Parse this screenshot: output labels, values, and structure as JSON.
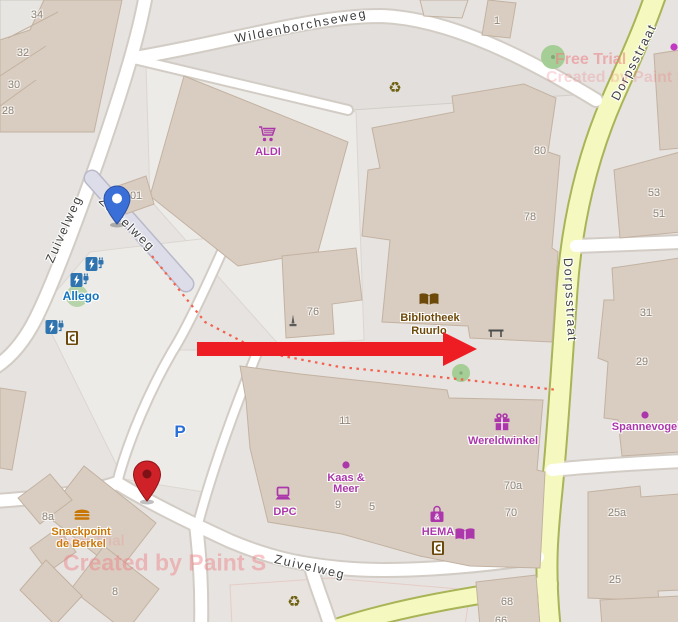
{
  "map": {
    "colors": {
      "background": "#e6e3e0",
      "building_fill": "#d9cdc1",
      "building_stroke": "#c3b2a1",
      "road_white": "#ffffff",
      "road_casing": "#d2ccc5",
      "secondary_road_fill": "#f5f9c0",
      "secondary_road_casing": "#a8b456",
      "pedestrian_road_fill": "#dcdde9",
      "path_dotted": "#f4604c",
      "shop_magenta": "#ab37ab",
      "amenity_brown": "#6e4a0a",
      "gastronomy_orange": "#c97704",
      "charging_blue": "#2f74ae",
      "parking_blue": "#2a6fd6",
      "watermark_pink": "#ef7e84",
      "arrow_red": "#ee1d23",
      "blue_pin": "#3b6fd8",
      "red_pin": "#cf2128"
    },
    "street_labels": [
      {
        "id": "wildenborchseweg",
        "text": "Wildenborchseweg",
        "x": 301,
        "y": 26,
        "rotate": -11
      },
      {
        "id": "zuivelweg-left",
        "text": "Zuivelweg",
        "x": 64,
        "y": 229,
        "rotate": -66
      },
      {
        "id": "zuivelweg-pedestrian",
        "text": "Zuivelweg",
        "x": 127,
        "y": 224,
        "rotate": 44
      },
      {
        "id": "zuivelweg-bottom",
        "text": "Zuivelweg",
        "x": 310,
        "y": 567,
        "rotate": 13
      },
      {
        "id": "dorpsstraat-north",
        "text": "Dorpsstraat",
        "x": 634,
        "y": 62,
        "rotate": -63
      },
      {
        "id": "dorpsstraat-mid",
        "text": "Dorpsstraat",
        "x": 570,
        "y": 300,
        "rotate": 87
      }
    ],
    "house_numbers": [
      {
        "text": "34",
        "x": 37,
        "y": 15
      },
      {
        "text": "32",
        "x": 23,
        "y": 53
      },
      {
        "text": "30",
        "x": 14,
        "y": 85
      },
      {
        "text": "28",
        "x": 8,
        "y": 111
      },
      {
        "text": "1",
        "x": 497,
        "y": 21
      },
      {
        "text": "101",
        "x": 133,
        "y": 196
      },
      {
        "text": "80",
        "x": 540,
        "y": 151
      },
      {
        "text": "78",
        "x": 530,
        "y": 217
      },
      {
        "text": "76",
        "x": 313,
        "y": 312
      },
      {
        "text": "53",
        "x": 654,
        "y": 193
      },
      {
        "text": "51",
        "x": 659,
        "y": 214
      },
      {
        "text": "31",
        "x": 646,
        "y": 313
      },
      {
        "text": "29",
        "x": 642,
        "y": 362
      },
      {
        "text": "11",
        "x": 345,
        "y": 421
      },
      {
        "text": "9",
        "x": 338,
        "y": 505
      },
      {
        "text": "5",
        "x": 372,
        "y": 507
      },
      {
        "text": "70a",
        "x": 513,
        "y": 486
      },
      {
        "text": "70",
        "x": 511,
        "y": 513
      },
      {
        "text": "8a",
        "x": 48,
        "y": 517
      },
      {
        "text": "8",
        "x": 115,
        "y": 592
      },
      {
        "text": "25a",
        "x": 617,
        "y": 513
      },
      {
        "text": "25",
        "x": 615,
        "y": 580
      },
      {
        "text": "68",
        "x": 507,
        "y": 602
      },
      {
        "text": "66",
        "x": 501,
        "y": 621
      }
    ],
    "poi_labels": [
      {
        "id": "aldi",
        "text": "ALDI",
        "x": 268,
        "y": 152,
        "color": "#ab37ab",
        "size": 11
      },
      {
        "id": "allego",
        "text": "Allego",
        "x": 81,
        "y": 296,
        "color": "#1273bf",
        "size": 12
      },
      {
        "id": "bibliotheek-line1",
        "text": "Bibliotheek",
        "x": 430,
        "y": 318,
        "color": "#6e4a0a",
        "size": 11
      },
      {
        "id": "bibliotheek-line2",
        "text": "Ruurlo",
        "x": 429,
        "y": 331,
        "color": "#6e4a0a",
        "size": 11
      },
      {
        "id": "wereldwinkel",
        "text": "Wereldwinkel",
        "x": 503,
        "y": 441,
        "color": "#ab37ab",
        "size": 11
      },
      {
        "id": "kaas-en-meer-line1",
        "text": "Kaas &",
        "x": 346,
        "y": 478,
        "color": "#ab37ab",
        "size": 11
      },
      {
        "id": "kaas-en-meer-line2",
        "text": "Meer",
        "x": 346,
        "y": 489,
        "color": "#ab37ab",
        "size": 11
      },
      {
        "id": "dpc",
        "text": "DPC",
        "x": 285,
        "y": 512,
        "color": "#ab37ab",
        "size": 11
      },
      {
        "id": "hema",
        "text": "HEMA",
        "x": 438,
        "y": 532,
        "color": "#ab37ab",
        "size": 11
      },
      {
        "id": "spannevogel",
        "text": "Spannevogel",
        "x": 646,
        "y": 427,
        "color": "#ab37ab",
        "size": 11
      },
      {
        "id": "snackpoint-line1",
        "text": "Snackpoint",
        "x": 81,
        "y": 532,
        "color": "#c97704",
        "size": 11
      },
      {
        "id": "snackpoint-line2",
        "text": "de Berkel",
        "x": 81,
        "y": 544,
        "color": "#c97704",
        "size": 11
      },
      {
        "id": "parking-p",
        "text": "P",
        "x": 180,
        "y": 432,
        "color": "#2a6fd6",
        "size": 17
      }
    ],
    "icons": [
      {
        "type": "cart",
        "name": "shopping-cart-icon",
        "x": 268,
        "y": 134,
        "color": "#ab37ab"
      },
      {
        "type": "charging",
        "name": "charging-station-icon",
        "x": 95,
        "y": 264,
        "color": "#2f74ae"
      },
      {
        "type": "charging",
        "name": "charging-station-icon",
        "x": 80,
        "y": 280,
        "color": "#2f74ae"
      },
      {
        "type": "charging",
        "name": "charging-station-icon",
        "x": 55,
        "y": 327,
        "color": "#2f74ae"
      },
      {
        "type": "atm",
        "name": "atm-icon",
        "x": 72,
        "y": 338,
        "color": "#6b480b"
      },
      {
        "type": "atm",
        "name": "atm-icon",
        "x": 438,
        "y": 548,
        "color": "#6b480b"
      },
      {
        "type": "book",
        "name": "library-book-icon",
        "x": 429,
        "y": 300,
        "color": "#6e4a0a"
      },
      {
        "type": "book",
        "name": "bookshop-icon",
        "x": 465,
        "y": 535,
        "color": "#ab37ab"
      },
      {
        "type": "gift",
        "name": "gift-shop-icon",
        "x": 502,
        "y": 422,
        "color": "#ab37ab"
      },
      {
        "type": "laptop",
        "name": "computer-shop-icon",
        "x": 283,
        "y": 494,
        "color": "#ab37ab"
      },
      {
        "type": "bag",
        "name": "department-store-bag-icon",
        "x": 437,
        "y": 514,
        "color": "#ab37ab"
      },
      {
        "type": "burger",
        "name": "fast-food-burger-icon",
        "x": 82,
        "y": 514,
        "color": "#c97704"
      },
      {
        "type": "recycle",
        "name": "recycling-icon",
        "x": 395,
        "y": 88,
        "color": "#6d600f"
      },
      {
        "type": "recycle",
        "name": "recycling-icon",
        "x": 294,
        "y": 602,
        "color": "#6d600f"
      },
      {
        "type": "monument",
        "name": "monument-icon",
        "x": 293,
        "y": 321,
        "color": "#5c5c5c"
      },
      {
        "type": "bench",
        "name": "bench-icon",
        "x": 496,
        "y": 333,
        "color": "#4d4d4d"
      },
      {
        "type": "dot",
        "name": "poi-dot",
        "x": 346,
        "y": 465,
        "color": "#ab37ab"
      },
      {
        "type": "dot",
        "name": "poi-dot",
        "x": 645,
        "y": 415,
        "color": "#ab37ab"
      },
      {
        "type": "dot",
        "name": "poi-dot-edge",
        "x": 674,
        "y": 47,
        "color": "#c13ac1"
      }
    ],
    "markers": {
      "blue_pin": {
        "x": 117,
        "y": 224
      },
      "red_pin": {
        "x": 147,
        "y": 501
      }
    },
    "arrow": {
      "x_start": 197,
      "x_head": 443,
      "x_tip": 477,
      "y_center": 349,
      "shaft_half": 7,
      "head_half": 17,
      "color": "#ee1d23"
    },
    "watermarks": [
      {
        "text": "Free Trial",
        "x": 555,
        "y": 60,
        "size": 16,
        "opacity": 0.55
      },
      {
        "text": "Created by Paint S",
        "x": 546,
        "y": 78,
        "size": 16,
        "opacity": 0.28
      },
      {
        "text": "Free Trial",
        "x": 58,
        "y": 541,
        "size": 15,
        "opacity": 0.2
      },
      {
        "text": "Created by Paint S",
        "x": 63,
        "y": 563,
        "size": 23,
        "opacity": 0.45
      }
    ]
  }
}
